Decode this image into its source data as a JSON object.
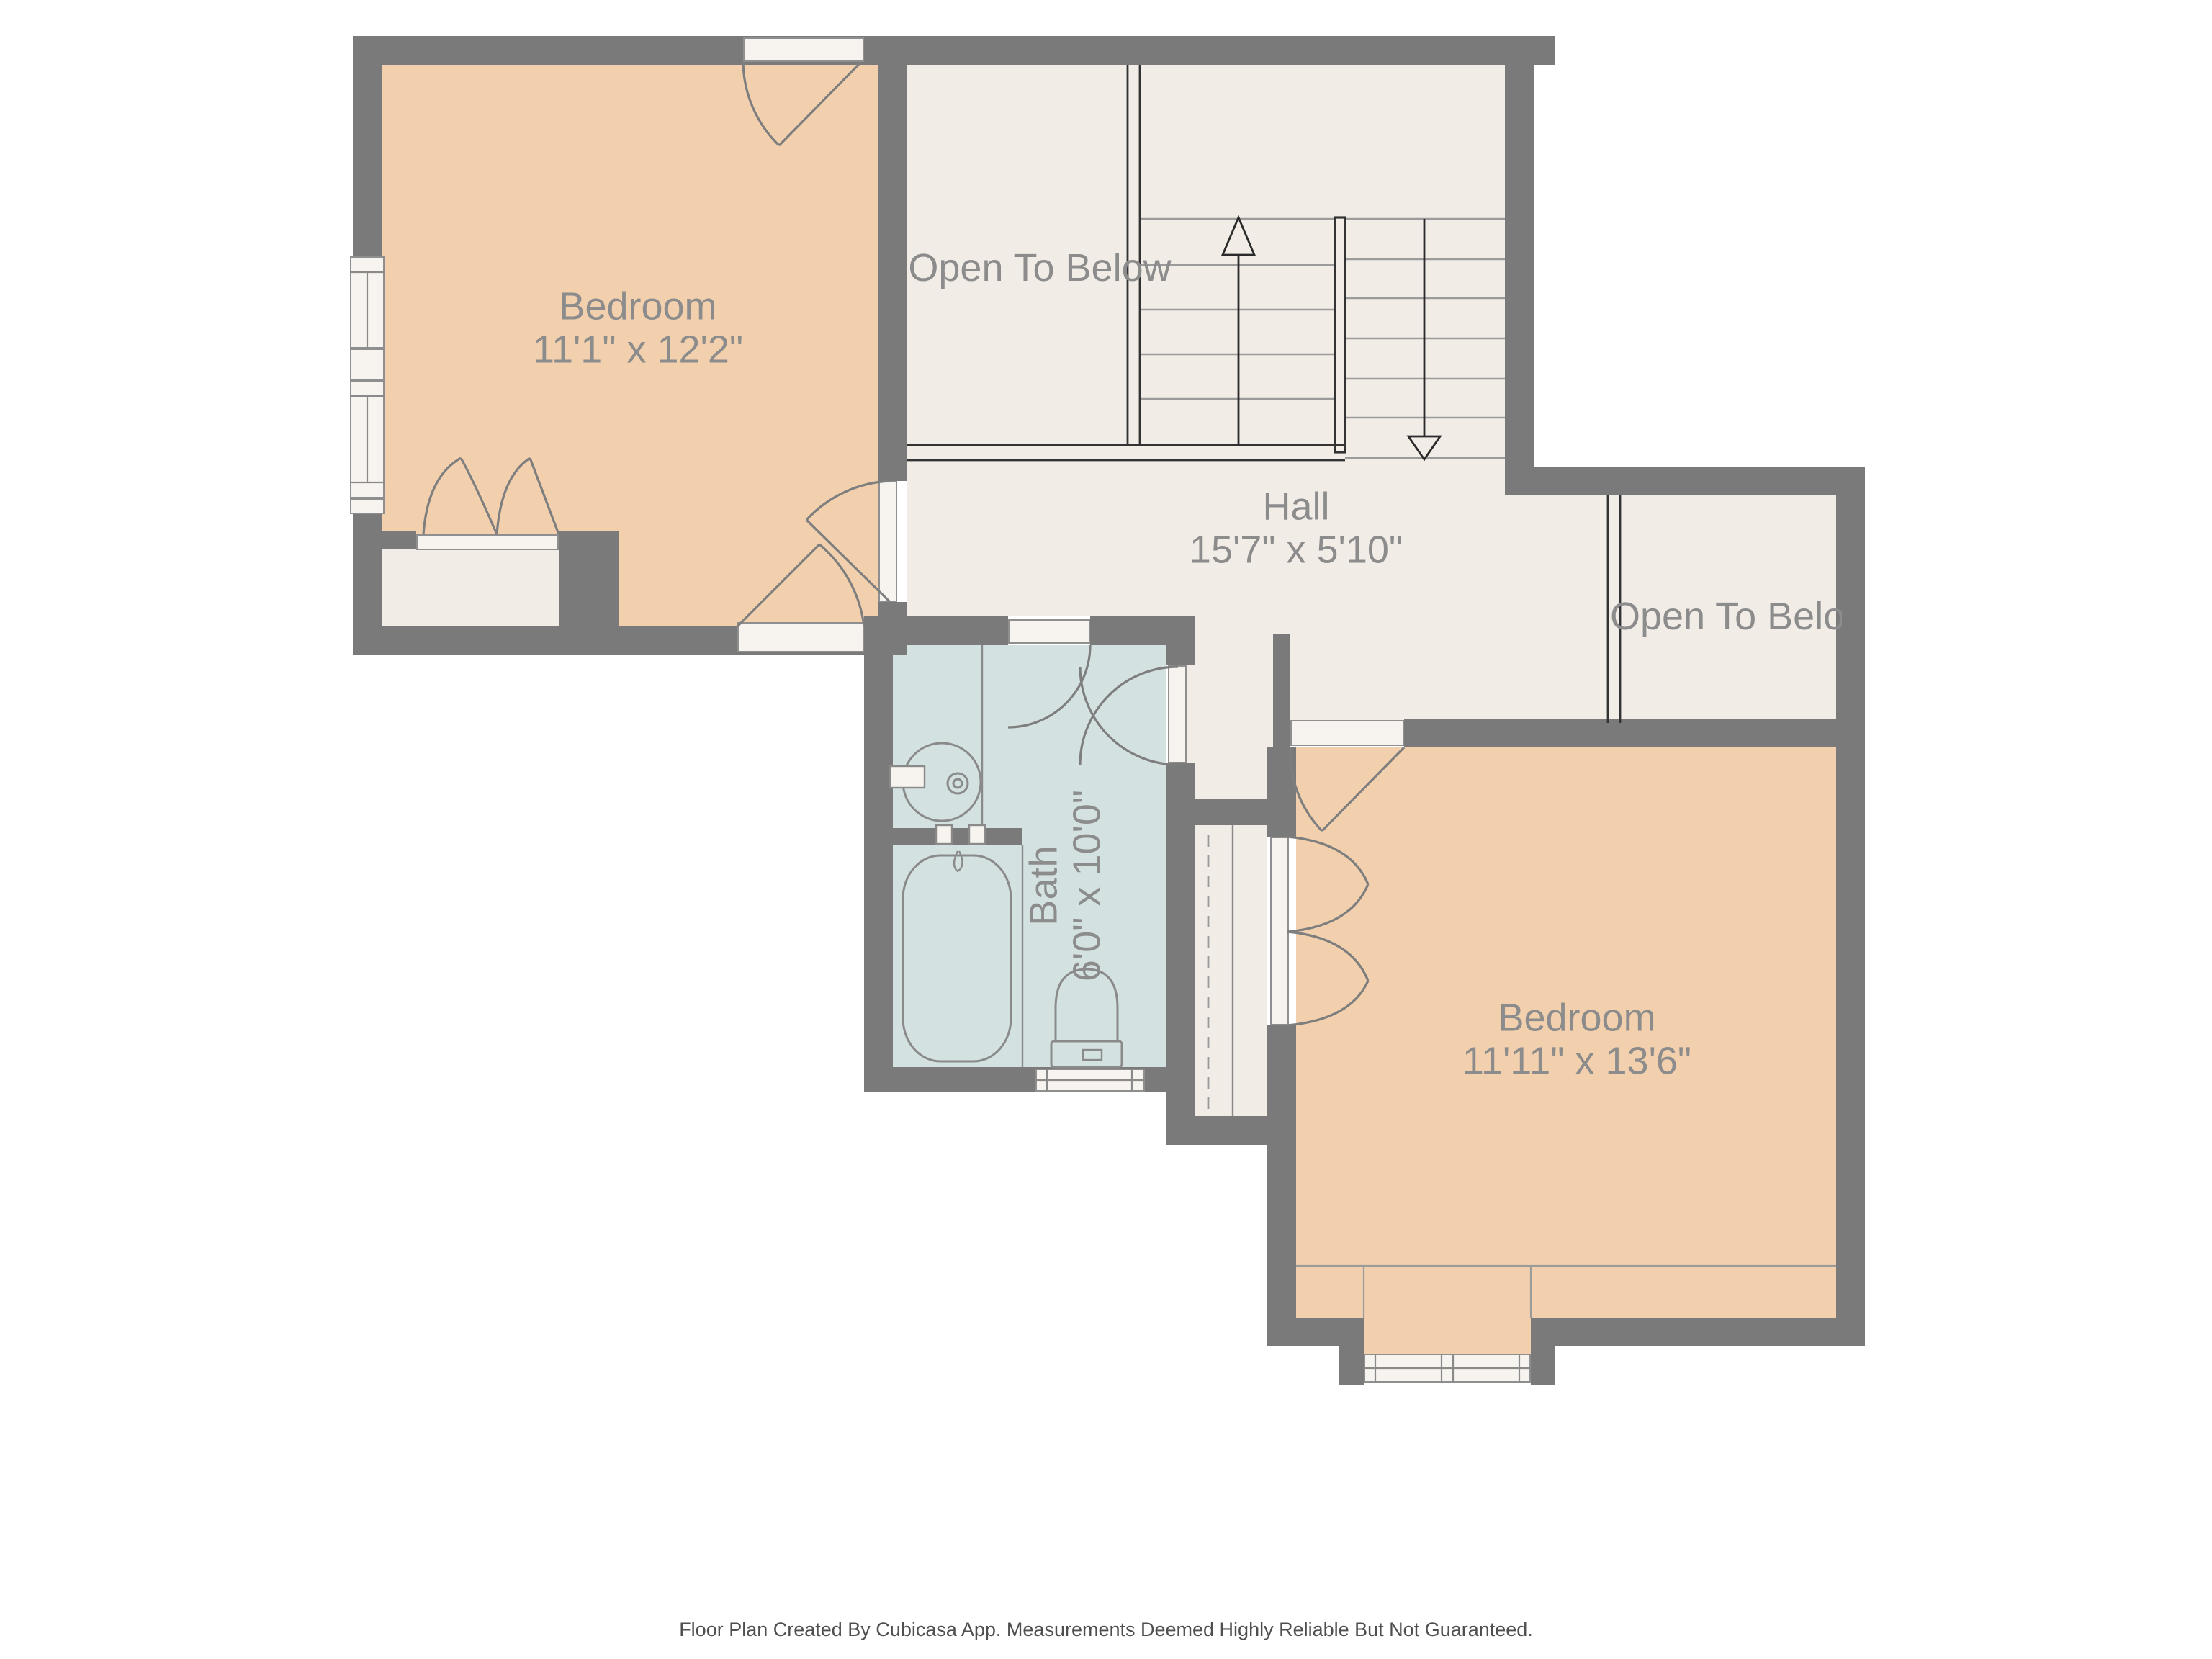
{
  "rooms": {
    "bedroom_top_left": {
      "name": "Bedroom",
      "dims": "11'1\" x 12'2\""
    },
    "open_to_below_top": {
      "name": "Open To Below"
    },
    "hall": {
      "name": "Hall",
      "dims": "15'7\" x 5'10\""
    },
    "open_to_below_right": {
      "name": "Open To Below"
    },
    "bath": {
      "name": "Bath",
      "dims": "6'0\" x 10'0\""
    },
    "bedroom_bottom_right": {
      "name": "Bedroom",
      "dims": "11'11\" x 13'6\""
    }
  },
  "stairs": {
    "up_flight_treads": 5,
    "down_flight_treads": 7,
    "arrows": [
      "up",
      "down"
    ]
  },
  "footer": {
    "text": "Floor Plan Created By Cubicasa App. Measurements Deemed Highly Reliable But Not Guaranteed."
  },
  "colors": {
    "wall": "#7a7a7a",
    "floor_cream": "#f2ece7",
    "floor_peach": "#f2d0ae",
    "floor_bath": "#d3e2e1",
    "sill_white": "#f7f3ef",
    "line_gray": "#8a8a8a",
    "dark_line": "#333333",
    "label_text": "#8c8c8c"
  }
}
